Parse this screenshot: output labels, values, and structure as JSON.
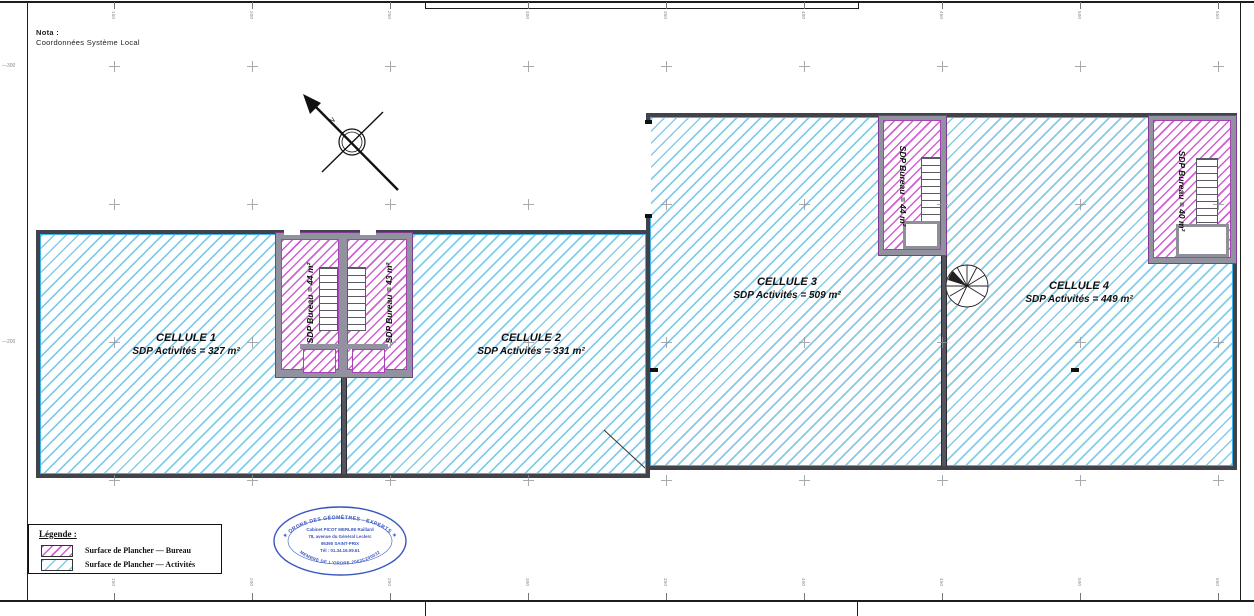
{
  "nota": {
    "title": "Nota :",
    "line": "Coordonnées Système Local"
  },
  "compass": {
    "label": "N"
  },
  "cells": [
    {
      "name": "CELLULE 1",
      "area": "SDP Activités = 327 m²"
    },
    {
      "name": "CELLULE 2",
      "area": "SDP Activités = 331 m²"
    },
    {
      "name": "CELLULE 3",
      "area": "SDP Activités = 509 m²"
    },
    {
      "name": "CELLULE 4",
      "area": "SDP Activités = 449 m²"
    }
  ],
  "bureaus": [
    {
      "label": "SDP Bureau = 44 m²"
    },
    {
      "label": "SDP Bureau = 43 m²"
    },
    {
      "label": "SDP Bureau = 44 m²"
    },
    {
      "label": "SDP Bureau = 40 m²"
    }
  ],
  "legend": {
    "title": "Légende :",
    "items": [
      {
        "label": "Surface de Plancher — Bureau",
        "type": "bureau"
      },
      {
        "label": "Surface de Plancher — Activités",
        "type": "activites"
      }
    ]
  },
  "stamp": {
    "arc_top": "✶ ORDRE DES GÉOMÈTRES - EXPERTS ✶",
    "lines": [
      "Cabinet PICOT MERLINI Raillard",
      "78, avenue du Général Leclerc",
      "95390 SAINT-PRIX",
      "Tél : 01.34.16.09.61"
    ],
    "arc_bottom": "MEMBRE DE L'ORDRE 2002C200032"
  },
  "grid": {
    "columns": [
      114,
      252,
      390,
      528,
      666,
      804,
      942,
      1080,
      1218
    ],
    "rows": [
      66,
      204,
      342,
      480
    ],
    "top_labels": [
      "150",
      "200",
      "250",
      "300",
      "350",
      "400",
      "450",
      "500",
      "550"
    ],
    "bottom_labels": [
      "150",
      "200",
      "250",
      "300",
      "350",
      "400",
      "450",
      "500",
      "550"
    ],
    "left_labels": [
      {
        "row": 0,
        "text": "300"
      },
      {
        "row": 2,
        "text": "200"
      }
    ]
  },
  "colors": {
    "activites_hatch": "#85cbea",
    "bureau_hatch": "#cf5fd3",
    "wall": "#42424a",
    "bureau_wall": "#8a3d9e",
    "stamp_blue": "#3a57c0",
    "frame": "#222222"
  }
}
